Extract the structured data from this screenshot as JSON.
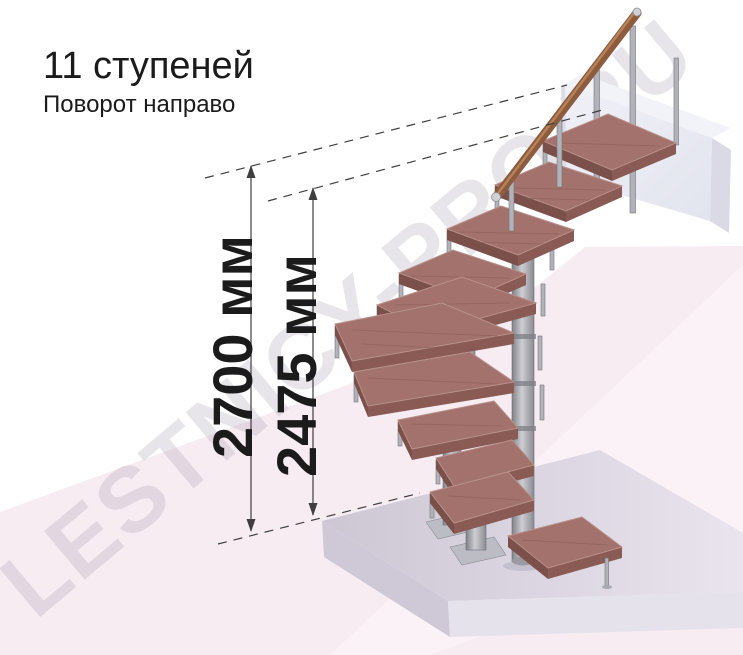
{
  "header": {
    "title": "11 ступеней",
    "subtitle": "Поворот направо"
  },
  "dimensions": {
    "total_height": {
      "label": "2700 мм"
    },
    "floor_to_top_step": {
      "label": "2475 мм"
    }
  },
  "watermark": {
    "text": "LESTNICY-PRO.RU"
  },
  "staircase": {
    "steps_count": 11,
    "turn_direction": "направо"
  },
  "colors": {
    "background": "#ffffff",
    "backdrop_pink": "#f8ecf3",
    "slab_lavender": "#d8d2de",
    "platform_white": "#eaebf2",
    "step_wood": "#a3726d",
    "step_edge": "#7b4f4a",
    "handrail_wood": "#8d5c3f",
    "metal": "#9a9aa1",
    "dimension_line": "#3f3f3f",
    "text": "#1b1b1b",
    "watermark": "#8e8298"
  }
}
